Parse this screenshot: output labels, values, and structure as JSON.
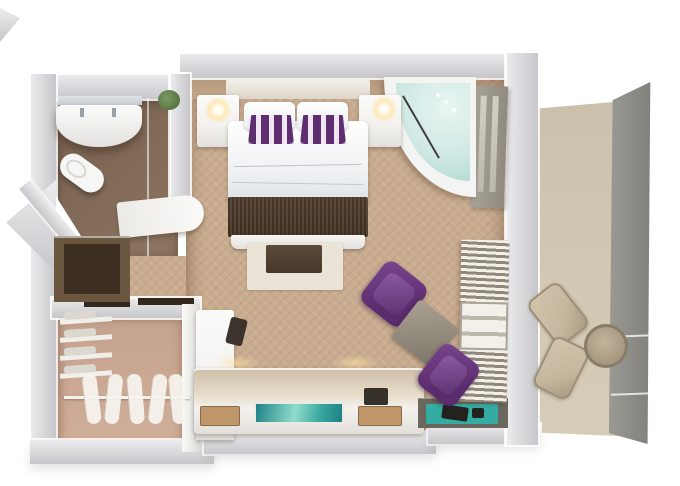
{
  "meta": {
    "description": "Top-down 3D rendered floor plan of a hotel suite with bedroom, bathroom, walk-in closet and balcony",
    "canvas": {
      "width": 680,
      "height": 486
    }
  },
  "rooms": {
    "bedroom": "Bedroom and living area",
    "bathroom": "Bathroom",
    "closet": "Walk-in closet",
    "hallway": "Entry hall",
    "balcony": "Private balcony"
  },
  "furniture": {
    "bed": "Double bed with white linens and purple striped accent pillows",
    "headboard": "Headboard",
    "nightstand_left": "Left nightstand with lamp",
    "nightstand_right": "Right nightstand with lamp",
    "runner": "Dark brown bed runner",
    "rug": "Rug with dark ottoman",
    "ottoman": "Ottoman",
    "corner_tub": "Corner whirlpool tub",
    "balcony_door": "Balcony door",
    "armchair_1": "Purple armchair",
    "armchair_2": "Purple armchair",
    "side_table": "Square side table",
    "towel_shelf": "Linen and towel shelving",
    "console": "Media console with flat TV",
    "tv": "Television screen",
    "desk": "Desk unit",
    "stool": "Dark stool",
    "ledge": "Luggage bench with teal tray",
    "vanity": "Bathroom vanity with sink",
    "toilet": "Toilet",
    "mirror": "Vanity mirror",
    "bathroom_door": "Open bathroom door",
    "minibar": "Minibar cabinet nook",
    "closet_shelves": "Closet shelves with folded linens",
    "closet_rail": "Hanging rail with hangers",
    "outdoor_chair_1": "Outdoor chair",
    "outdoor_chair_2": "Outdoor chair",
    "outdoor_table": "Round outdoor table",
    "plant": "Small plant"
  },
  "palette": {
    "wall_light": "#ececee",
    "wall_mid": "#c7c7cb",
    "carpet": "#c9ac90",
    "bath_floor": "#8d7663",
    "bath_floor_dark": "#76604e",
    "closet_floor": "#c5a28d",
    "balcony_floor": "#d0c6b2",
    "balcony_panel": "#8d8c87",
    "white_surface": "#f2f1ee",
    "bed_runner": "#483828",
    "pillow_purple": "#5e2e71",
    "water": "#cfe8e4",
    "water_deep": "#a8d6cf",
    "chair_purple": "#5b2c6d",
    "side_table": "#968e80",
    "towel_light": "#f3f0e9",
    "towel_dark": "#8f887b",
    "wood": "#c0976a",
    "tv_a": "#1f8187",
    "tv_b": "#8fdccb",
    "cabinet": "#6b563f",
    "cabinet_dark": "#3c2e21",
    "ledge": "#6b675e",
    "mat_teal": "#34aca3",
    "outdoor_chair": "#c6b79f",
    "lintel": "#32281e",
    "plant_green": "#5e7c49"
  }
}
